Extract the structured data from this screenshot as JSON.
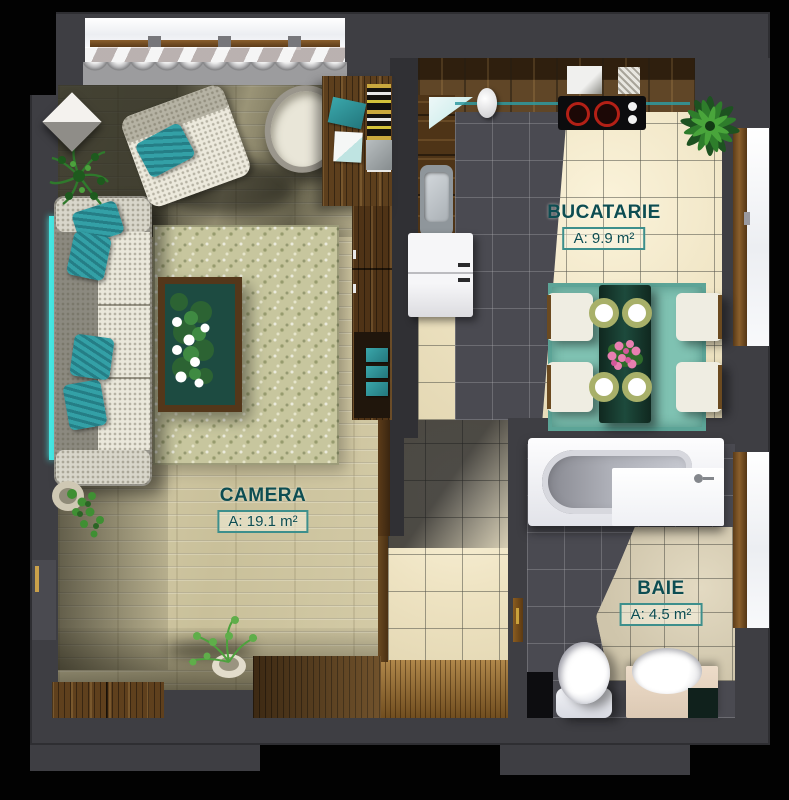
{
  "meta": {
    "title": "Apartment floor plan – rendered top view",
    "language": "ro"
  },
  "rooms": [
    {
      "id": "camera",
      "name": "CAMERA",
      "area_label": "A: 19.1 m²",
      "furniture": [
        "sofa",
        "teal-pillows",
        "coffee-table-with-flowers",
        "rug",
        "armchair",
        "round-chair",
        "desk",
        "bookshelf",
        "wardrobe",
        "sideboard-cabinets",
        "potted-plants",
        "led-strip",
        "window-with-curtain"
      ]
    },
    {
      "id": "bucatarie",
      "name": "BUCATARIE",
      "area_label": "A: 9.9 m²",
      "furniture": [
        "l-shaped-counter",
        "cooktop",
        "kettle",
        "sink",
        "fridge",
        "dining-table",
        "four-chairs",
        "plates",
        "flower-centerpiece",
        "teal-rug",
        "palm-plant",
        "window"
      ]
    },
    {
      "id": "baie",
      "name": "BAIE",
      "area_label": "A: 4.5 m²",
      "furniture": [
        "bathtub",
        "toilet",
        "vanity-sink",
        "window",
        "door"
      ]
    }
  ],
  "palette": {
    "background": "#000000",
    "wall": "#3e3e43",
    "wall_dark": "#303034",
    "label_text": "#0d4d52",
    "label_border": "#3d8f8c",
    "wood_floor": "#cfc7a3",
    "wood_dark": "#4e3417",
    "tile_cream": "#f1e7c9",
    "tile_dark": "#4a4a51",
    "tile_beige": "#d4cab1",
    "accent_teal": "#2f9aa0",
    "rug_teal": "#7fc2b2",
    "sofa_gray": "#96948b",
    "cushion_white": "#eae8db",
    "entry_wood": "#96682a",
    "plant_green": "#2e7d2b",
    "flower_pink": "#e87fb0",
    "burner_red": "#b32016",
    "led_teal": "#45e8e4"
  }
}
